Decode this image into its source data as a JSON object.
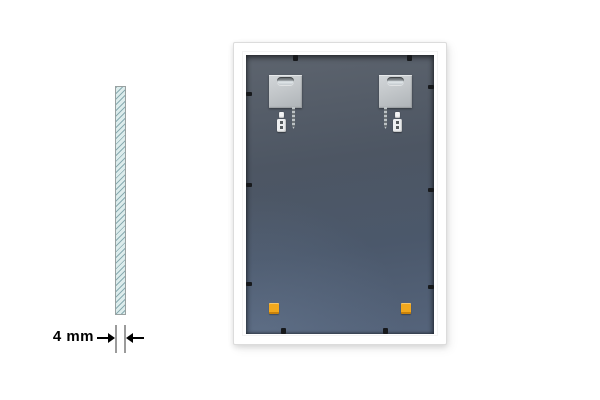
{
  "colors": {
    "background": "#ffffff",
    "frame-white": "#ffffff",
    "panel-top": "#5d646e",
    "panel-mid": "#4d5663",
    "panel-bottom": "#55647b",
    "glass-fill": "#dcecec",
    "glass-hatch": "#5e8a91",
    "glass-border": "#99a1a1",
    "pad-orange": "#f2a81d",
    "clip-black": "#17191c",
    "plate-silver": "#c3c7ca",
    "dimension-line-gray": "#9b9b9b",
    "text-black": "#000000"
  },
  "thickness_callout": {
    "label": "4 mm"
  },
  "mirror_back": {
    "hanger_plate_count": 2,
    "wall_anchor_count": 2,
    "screw_count": 2,
    "corner_pad_count": 2,
    "retainer_clip_count": 10
  }
}
